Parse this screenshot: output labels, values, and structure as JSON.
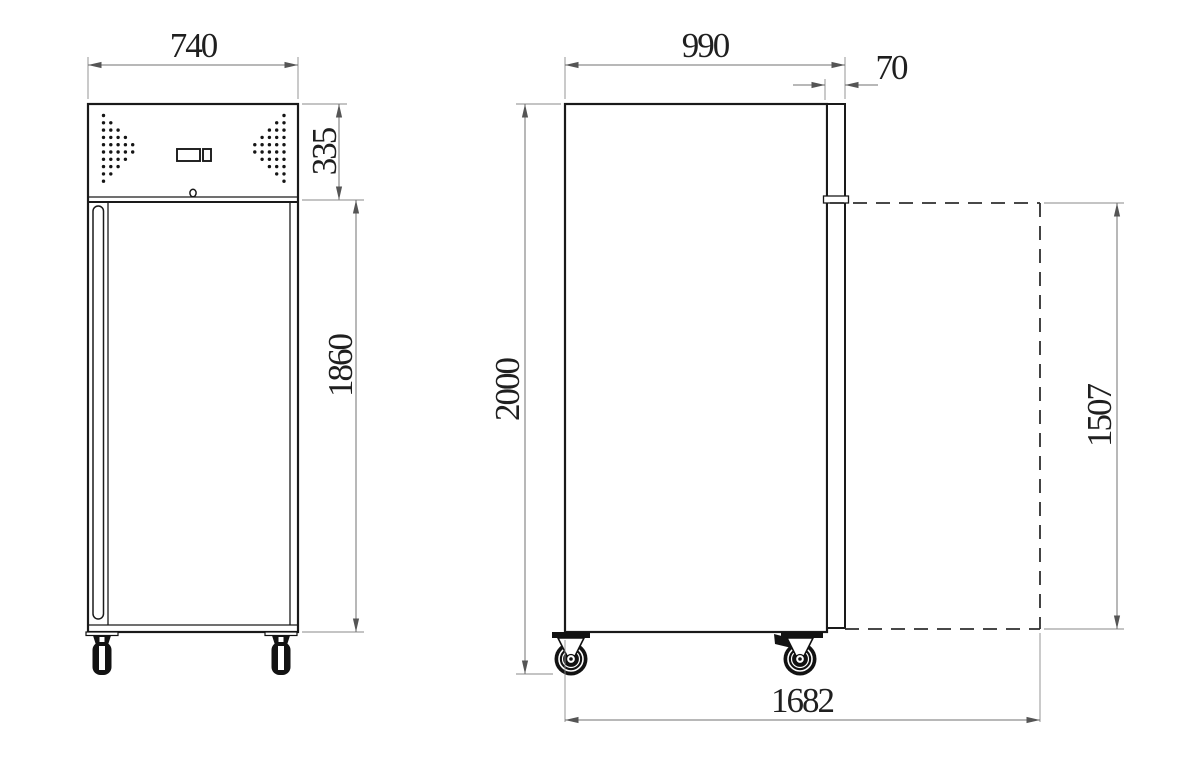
{
  "title": "Upright refrigerator technical drawing (front and side views)",
  "colors": {
    "object_line": "#1a1a1a",
    "dimension_line": "#707070",
    "text": "#1f1f1f",
    "background": "#ffffff"
  },
  "front_view": {
    "name": "front view",
    "dimensions": {
      "overall_width": "740",
      "machine_compartment_height": "335",
      "door_section_height": "1860"
    },
    "features": [
      "vent-dot-grid-left",
      "vent-dot-grid-right",
      "control-display",
      "lock-hole",
      "door-handle",
      "two-casters"
    ]
  },
  "side_view": {
    "name": "side view",
    "dimensions": {
      "overall_depth": "990",
      "door_thickness": "70",
      "overall_height": "2000",
      "open_door_height": "1507",
      "depth_with_door_open": "1682"
    },
    "features": [
      "door-slab",
      "door-hinge",
      "open-door-dashed-envelope",
      "swivel-caster",
      "braked-caster"
    ]
  },
  "vent_pattern": {
    "rows": [
      1,
      2,
      3,
      4,
      5,
      5,
      4,
      3,
      2,
      1
    ],
    "step": 7.3,
    "dot_radius": 1.7
  }
}
